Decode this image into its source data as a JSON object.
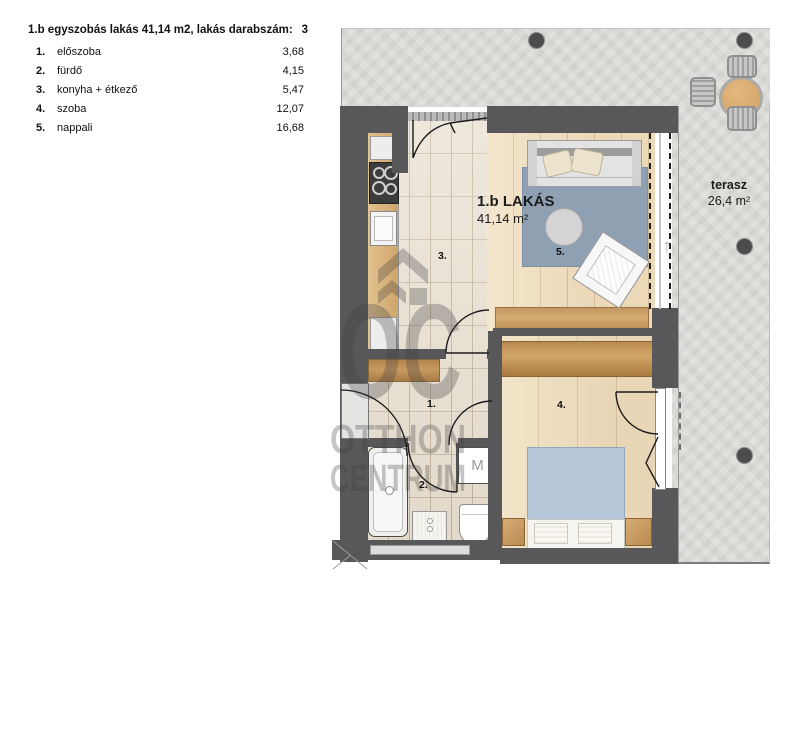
{
  "header": {
    "title": "1.b egyszobás lakás 41,14 m2, lakás darabszám:",
    "count": "3"
  },
  "room_list": [
    {
      "num": "1.",
      "name": "előszoba",
      "area": "3,68"
    },
    {
      "num": "2.",
      "name": "fürdő",
      "area": "4,15"
    },
    {
      "num": "3.",
      "name": "konyha + étkező",
      "area": "5,47"
    },
    {
      "num": "4.",
      "name": "szoba",
      "area": "12,07"
    },
    {
      "num": "5.",
      "name": "nappali",
      "area": "16,68"
    }
  ],
  "plan": {
    "apartment_label": "1.b LAKÁS",
    "apartment_area": "41,14 m²",
    "terrace_label": "terasz",
    "terrace_area": "26,4 m²",
    "labels": {
      "hall": "1.",
      "bath": "2.",
      "kitchen": "3.",
      "bedroom": "4.",
      "living": "5."
    },
    "washer_label": "M",
    "slide_arrow": "↑"
  },
  "watermark": {
    "monogram": "OC",
    "line1": "OTTHON",
    "line2": "CENTRUM"
  },
  "colors": {
    "wall": "#58585a",
    "terrace": "#d9d9d6",
    "tile_floor": "#e9e0d1",
    "wood_floor": "#f0ddbc",
    "cabinet_wood": "#c79a60",
    "rug": "#8fa0b2",
    "bed_cover": "#b6c7d9"
  }
}
